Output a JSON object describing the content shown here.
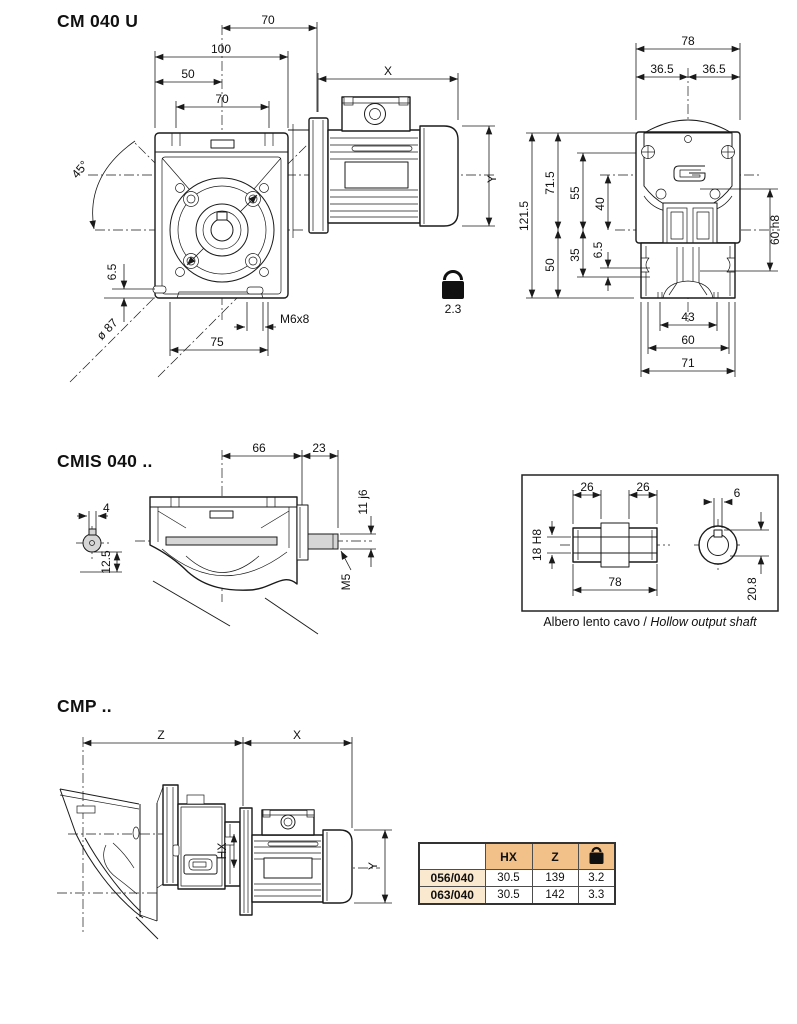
{
  "colors": {
    "line": "#1a1a1a",
    "table_header_bg": "#f2c189",
    "table_label_bg": "#fbe9cf",
    "shaft_fill": "#d6d6d6"
  },
  "cm040u": {
    "title": "CM 040 U",
    "dims": {
      "d70_top": "70",
      "d100": "100",
      "d50": "50",
      "d70_bolts": "70",
      "x": "X",
      "y": "Y",
      "angle": "45°",
      "d65": "6.5",
      "bolt_circle": "ø 87",
      "tap": "M6x8",
      "d75": "75"
    },
    "weight": {
      "unit": "Kg",
      "value": "2.3"
    },
    "rear": {
      "d78": "78",
      "d365l": "36.5",
      "d365r": "36.5",
      "d1215": "121.5",
      "d715": "71.5",
      "d55": "55",
      "d40": "40",
      "d50": "50",
      "d35": "35",
      "d65": "6.5",
      "d60h8": "60 h8",
      "d43": "43",
      "d60": "60",
      "d71": "71"
    }
  },
  "cmis": {
    "title": "CMIS 040 ..",
    "dims": {
      "d66": "66",
      "d23": "23",
      "d4": "4",
      "d125": "12.5",
      "d11j6": "11 j6",
      "m5": "M5"
    }
  },
  "hollow": {
    "caption_it": "Albero lento cavo",
    "caption_sep": " / ",
    "caption_en": "Hollow output shaft",
    "dims": {
      "d26l": "26",
      "d26r": "26",
      "d6": "6",
      "d18h8": "18 H8",
      "d78": "78",
      "d208": "20.8"
    }
  },
  "cmp": {
    "title": "CMP ..",
    "dims": {
      "z": "Z",
      "x": "X",
      "hx": "HX",
      "y": "Y"
    }
  },
  "table": {
    "col_hx": "HX",
    "col_z": "Z",
    "col_kg": "Kg",
    "rows": [
      {
        "model": "056/040",
        "hx": "30.5",
        "z": "139",
        "kg": "3.2"
      },
      {
        "model": "063/040",
        "hx": "30.5",
        "z": "142",
        "kg": "3.3"
      }
    ]
  }
}
